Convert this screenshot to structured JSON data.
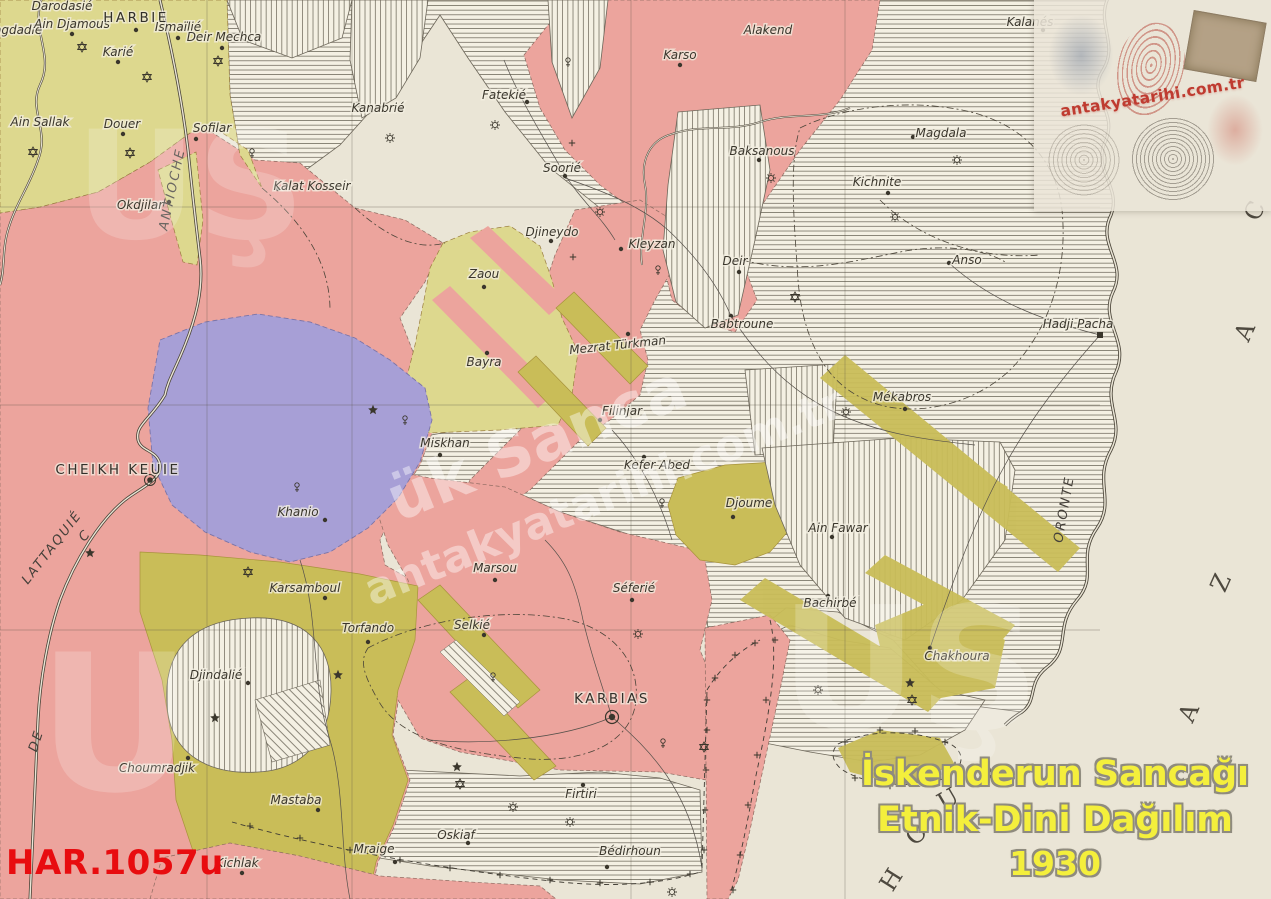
{
  "window": {
    "width": 1271,
    "height": 899
  },
  "map": {
    "places": [
      {
        "name": "Darodasié"
      },
      {
        "name": "Bagdadié"
      },
      {
        "name": "Ain Djamous"
      },
      {
        "name": "HARBIE"
      },
      {
        "name": "Ismaïlié"
      },
      {
        "name": "Deir Mechca"
      },
      {
        "name": "Karié"
      },
      {
        "name": "Ain Sallak"
      },
      {
        "name": "Douer"
      },
      {
        "name": "Sofilar"
      },
      {
        "name": "Okdjilar"
      },
      {
        "name": "Kalat Kosseir"
      },
      {
        "name": "Kanabrié"
      },
      {
        "name": "Fatekié"
      },
      {
        "name": "Soorié"
      },
      {
        "name": "Djineydo"
      },
      {
        "name": "Kleyzan"
      },
      {
        "name": "Zaou"
      },
      {
        "name": "Bayra"
      },
      {
        "name": "Mezrat Türkman"
      },
      {
        "name": "Filinjar"
      },
      {
        "name": "Miskhan"
      },
      {
        "name": "Kefer Abed"
      },
      {
        "name": "CHEIKH KEUIE"
      },
      {
        "name": "Khanio"
      },
      {
        "name": "Karsamboul"
      },
      {
        "name": "Torfando"
      },
      {
        "name": "Marsou"
      },
      {
        "name": "Selkié"
      },
      {
        "name": "Séferié"
      },
      {
        "name": "Djoume"
      },
      {
        "name": "Ain Fawar"
      },
      {
        "name": "Bachirbé"
      },
      {
        "name": "Mékabros"
      },
      {
        "name": "Deir"
      },
      {
        "name": "Babtroune"
      },
      {
        "name": "Anso"
      },
      {
        "name": "Hadji Pacha"
      },
      {
        "name": "Kichnite"
      },
      {
        "name": "Magdala"
      },
      {
        "name": "Baksanous"
      },
      {
        "name": "Karso"
      },
      {
        "name": "Alakend"
      },
      {
        "name": "Kalanés"
      },
      {
        "name": "Djindalié"
      },
      {
        "name": "Choumradjik"
      },
      {
        "name": "Mastaba"
      },
      {
        "name": "Kichlak"
      },
      {
        "name": "Mraige"
      },
      {
        "name": "Oskiaf"
      },
      {
        "name": "KARBIAS"
      },
      {
        "name": "Firtiri"
      },
      {
        "name": "Bédirhoun"
      },
      {
        "name": "Chakhoura"
      }
    ],
    "routes": {
      "antioche": "ANTIOCHE",
      "lattaquie": "LATTAQUIÉ",
      "lattaquie_c": "C",
      "lattaquie_de": "DE",
      "oronte": "ORONTE"
    },
    "margins": {
      "caza": [
        "C",
        "A",
        "Z",
        "A"
      ],
      "hour": [
        "H",
        "O",
        "U",
        "R"
      ]
    }
  },
  "overlays": {
    "catalog_code": "HAR.1057u",
    "title": {
      "line1": "İskenderun Sancağı",
      "line2": "Etnik-Dini Dağılım",
      "line3": "1930"
    },
    "watermark": {
      "site": "antakyatarihi.com.tr",
      "diag_large": "ük Sanca",
      "letters": "UŞ",
      "letter_single": "U"
    },
    "logo": {
      "site": "antakyatarihi.com.tr"
    }
  },
  "colors": {
    "paper": "#eae5d6",
    "pink": "#eca49d",
    "yellow": "#ddd88e",
    "olive": "#c9bd58",
    "purple": "#a79fd6",
    "hatch_line": "#6f6a5c",
    "ink": "#3a362c",
    "catalog_red": "#e80c0f",
    "title_yellow": "#f4ef3c",
    "logo_red": "#bf3b30"
  }
}
